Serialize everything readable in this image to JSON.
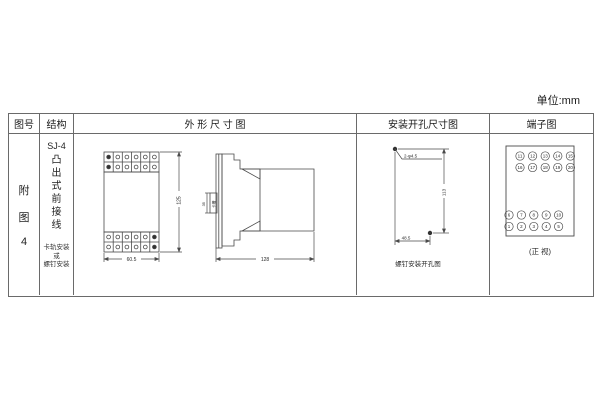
{
  "unit_label": "单位:mm",
  "table": {
    "headers": {
      "fig_no": "图号",
      "structure": "结构",
      "outline": "外 形 尺 寸 图",
      "mounting": "安装开孔尺寸图",
      "terminal": "端子图"
    },
    "fig_lines": [
      "附",
      "图",
      "4"
    ],
    "structure": {
      "model": "SJ-4",
      "desc_chars": [
        "凸",
        "出",
        "式",
        "前",
        "接",
        "线"
      ],
      "note_lines": [
        "卡轨安装",
        "或",
        "螺钉安装"
      ]
    }
  },
  "outline": {
    "front_width": "60.5",
    "front_height": "125",
    "side_depth": "128",
    "rail_width": "35",
    "slot_label": "卡槽"
  },
  "mounting": {
    "holes_label": "2-φ4.5",
    "vertical": "113",
    "horizontal": "48.5",
    "caption": "螺钉安装开孔图"
  },
  "terminal": {
    "top_rows": [
      [
        "11",
        "12",
        "13",
        "14",
        "15"
      ],
      [
        "16",
        "17",
        "18",
        "19",
        "20"
      ]
    ],
    "bottom_rows": [
      [
        "6",
        "7",
        "8",
        "9",
        "10"
      ],
      [
        "1",
        "2",
        "3",
        "4",
        "5"
      ]
    ],
    "caption": "(正 视)"
  }
}
